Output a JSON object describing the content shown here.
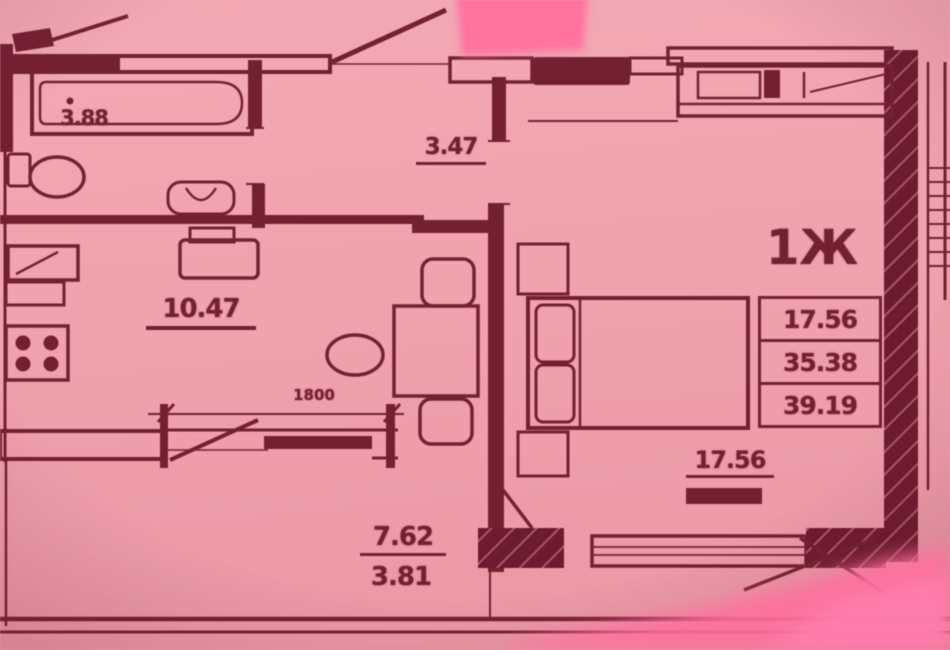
{
  "plan": {
    "unit_type_label": "1Ж",
    "area_summary_table": {
      "rows": [
        {
          "value": "17.56"
        },
        {
          "value": "35.38"
        },
        {
          "value": "39.19"
        }
      ]
    },
    "room_labels": {
      "bathroom": "3.88",
      "hallway": "3.47",
      "kitchen": "10.47",
      "living_room": "17.56",
      "balcony_full": "7.62",
      "balcony_reduced": "3.81"
    },
    "dimension_labels": {
      "kitchen_window_width": "1800"
    }
  },
  "colors": {
    "paper_pink": "#f0a2ae",
    "ink_maroon": "#742033",
    "glare_pink": "#ff6f9f"
  }
}
